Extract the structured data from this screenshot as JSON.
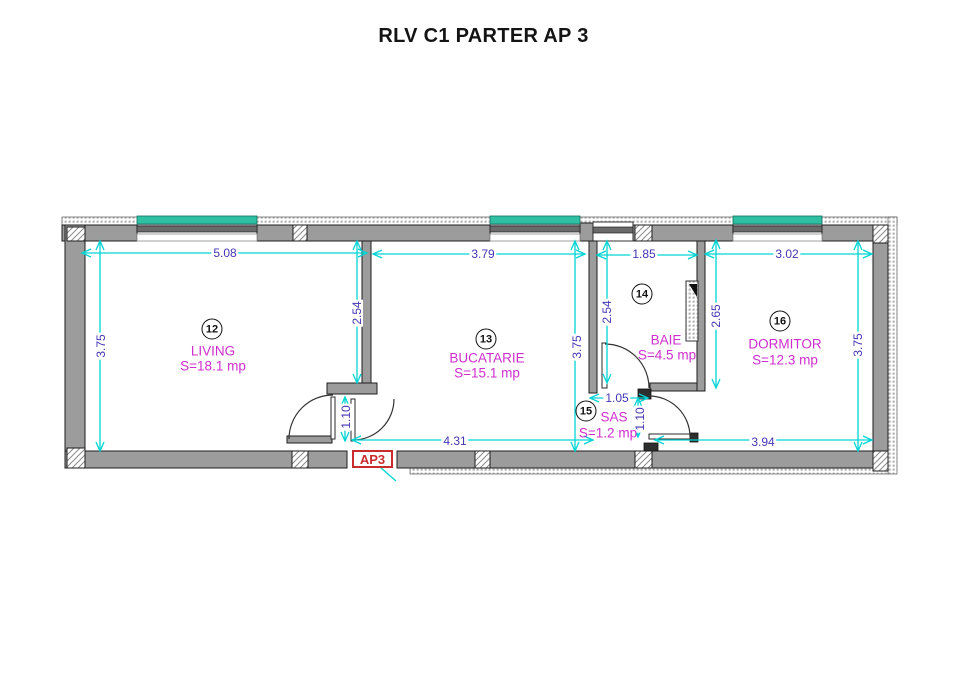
{
  "title": "RLV C1 PARTER AP 3",
  "plan": {
    "apartment_label": "AP3",
    "rooms": [
      {
        "number": "12",
        "name": "LIVING",
        "area": "S=18.1 mp"
      },
      {
        "number": "13",
        "name": "BUCATARIE",
        "area": "S=15.1 mp"
      },
      {
        "number": "14",
        "name": "BAIE",
        "area": "S=4.5 mp"
      },
      {
        "number": "15",
        "name": "SAS",
        "area": "S=1.2 mp"
      },
      {
        "number": "16",
        "name": "DORMITOR",
        "area": "S=12.3 mp"
      }
    ],
    "dims": {
      "living_width": "5.08",
      "kitchen_width": "3.79",
      "bath_width": "1.85",
      "bedroom_width": "3.02",
      "living_height": "3.75",
      "partition_living": "2.54",
      "kitchen_height": "3.75",
      "bath_left": "2.54",
      "bath_right": "2.65",
      "bedroom_height": "3.75",
      "kitchen_bottom": "4.31",
      "sas_width": "1.05",
      "bedroom_bottom": "3.94",
      "entry_door": "1.10",
      "sas_door": "1.10"
    },
    "colors": {
      "dim": "#00d4d4",
      "dimtext": "#4336b3",
      "room": "#cf2ecf",
      "red": "#c92c2c",
      "window": "#2fc0a4",
      "wall": "#9c9c9c"
    }
  }
}
